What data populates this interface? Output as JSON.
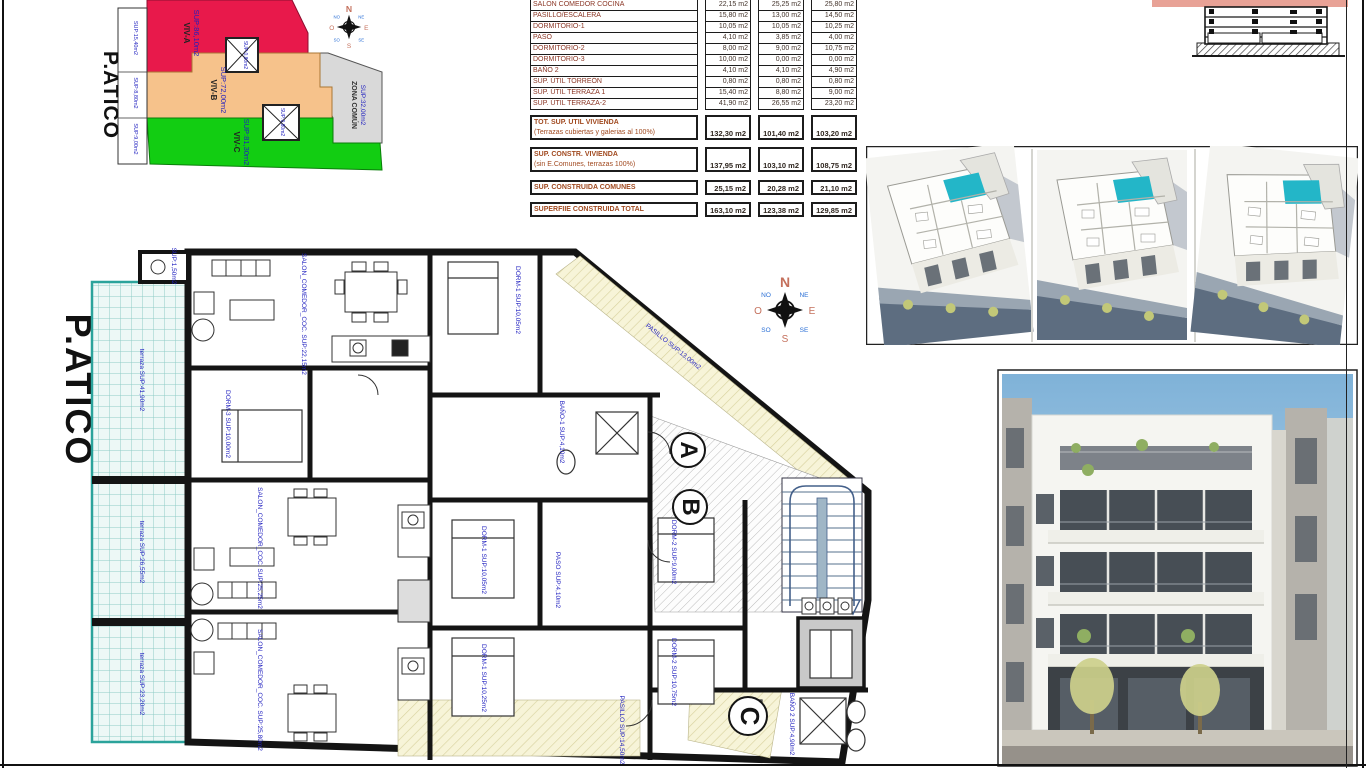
{
  "site_plan": {
    "title": "P.ATICO",
    "viv_a": {
      "name": "VIV-A",
      "sup": "SUP:86,10m2"
    },
    "viv_b": {
      "name": "VIV-B",
      "sup": "SUP:72,00m2"
    },
    "viv_c": {
      "name": "VIV-C",
      "sup": "SUP:81,30m2"
    },
    "zona_comun": {
      "name": "ZONA COMÚN",
      "sup": "SUP:32,00m2"
    },
    "torreon_a": "SUP:0,80m2",
    "torreon_b": "SUP:0,80m2",
    "terraza_labels": [
      "SUP:15,40m2",
      "SUP:8,80m2",
      "SUP:9,00m2"
    ]
  },
  "compass": {
    "n": "N",
    "s": "S",
    "e": "E",
    "o": "O",
    "ne": "NE",
    "se": "SE",
    "so": "SO",
    "no": "NO"
  },
  "area_table": {
    "unit": "m2",
    "rows": [
      {
        "label": "SALON COMEDOR COCINA",
        "a": "22,15 m2",
        "b": "25,25 m2",
        "c": "25,80 m2"
      },
      {
        "label": "PASILLO/ESCALERA",
        "a": "15,80 m2",
        "b": "13,00 m2",
        "c": "14,50 m2"
      },
      {
        "label": "DORMITORIO-1",
        "a": "10,05 m2",
        "b": "10,05 m2",
        "c": "10,25 m2"
      },
      {
        "label": "PASO",
        "a": "4,10 m2",
        "b": "3,85 m2",
        "c": "4,00 m2"
      },
      {
        "label": "DORMITORIO-2",
        "a": "8,00 m2",
        "b": "9,00 m2",
        "c": "10,75 m2"
      },
      {
        "label": "DORMITORIO-3",
        "a": "10,00 m2",
        "b": "0,00 m2",
        "c": "0,00 m2"
      },
      {
        "label": "BAÑO 2",
        "a": "4,10 m2",
        "b": "4,10 m2",
        "c": "4,90 m2"
      },
      {
        "label": "SUP. ÚTIL TORREÓN",
        "a": "0,80 m2",
        "b": "0,80 m2",
        "c": "0,80 m2"
      },
      {
        "label": "SUP. ÚTIL TERRAZA 1",
        "a": "15,40 m2",
        "b": "8,80 m2",
        "c": "9,00 m2"
      },
      {
        "label": "SUP. ÚTIL TERRAZA-2",
        "a": "41,90 m2",
        "b": "26,55 m2",
        "c": "23,20 m2"
      }
    ],
    "totals": [
      {
        "label": "TOT. SUP. UTIL VIVIENDA",
        "sub": "(Terrazas cubiertas y galerias al 100%)",
        "a": "132,30 m2",
        "b": "101,40 m2",
        "c": "103,20 m2"
      },
      {
        "label": "SUP. CONSTR. VIVIENDA",
        "sub": "(sin E.Comunes, terrazas 100%)",
        "a": "137,95 m2",
        "b": "103,10 m2",
        "c": "108,75 m2"
      },
      {
        "label": "SUP. CONSTRUIDA COMUNES",
        "sub": "",
        "a": "25,15 m2",
        "b": "20,28 m2",
        "c": "21,10 m2"
      },
      {
        "label": "SUPERFIIE CONSTRUIDA TOTAL",
        "sub": "",
        "a": "163,10 m2",
        "b": "123,38 m2",
        "c": "129,85 m2"
      }
    ]
  },
  "floor_plan": {
    "title": "P.ATICO",
    "marks": {
      "a": "A",
      "b": "B",
      "c": "C"
    },
    "labels": [
      "terraza SUP:41,90m2",
      "terraza SUP:26,55m2",
      "terraza SUP:23,20m2",
      "SALON_COMEDOR_COC. SUP:22,15m2",
      "SALON_COMEDOR_COC. SUP:25,25m2",
      "SALON_COMEDOR_COC. SUP:25,80m2",
      "DORM-1 SUP:10,05m2",
      "DORM-1 SUP:10,05m2",
      "DORM-1 SUP:10,25m2",
      "DORM-2 SUP:9,00m2",
      "DORM-2 SUP:10,75m2",
      "DORM-3 SUP:10,00m2",
      "PASILLO SUP:13,00m2",
      "PASO SUP:4,10m2",
      "BAÑO-1 SUP:4,10m2",
      "BAÑO 2 SUP:4,90m2",
      "PASILLO SUP:14,50m2",
      "SUP:1,50m2"
    ]
  }
}
